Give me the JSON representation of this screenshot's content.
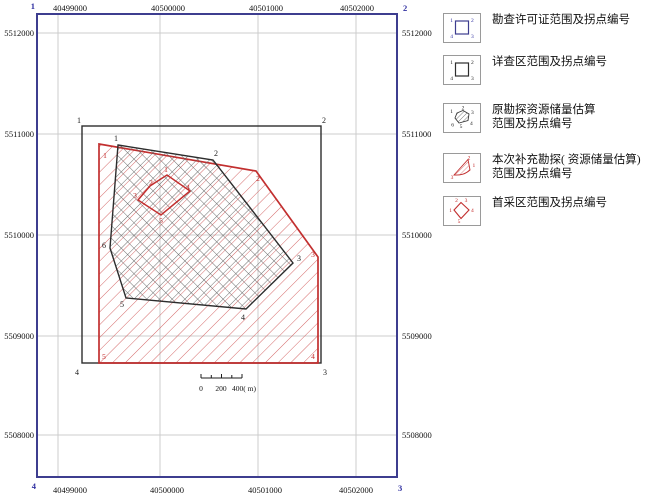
{
  "axes": {
    "x_labels": [
      "40499000",
      "40500000",
      "40501000",
      "40502000"
    ],
    "y_labels": [
      "5512000",
      "5511000",
      "5510000",
      "5509000",
      "5508000"
    ]
  },
  "permit_frame": {
    "corners": [
      "1",
      "2",
      "3",
      "4"
    ]
  },
  "survey_rect": {
    "corners": [
      "1",
      "2",
      "3",
      "4"
    ]
  },
  "exploration_polygon": {
    "corners": [
      "1",
      "2",
      "3",
      "4",
      "5",
      "6"
    ]
  },
  "supplement_polygon": {
    "corners": [
      "1",
      "2",
      "3",
      "4",
      "5"
    ]
  },
  "first_mining_area": {
    "corners": [
      "1",
      "2",
      "3",
      "4",
      "5"
    ]
  },
  "scale_bar": {
    "labels": [
      "0",
      "200",
      "400( m)"
    ]
  },
  "legend": {
    "items": [
      {
        "lines": [
          "勘查许可证范围及拐点编号"
        ]
      },
      {
        "lines": [
          "详查区范围及拐点编号"
        ]
      },
      {
        "lines": [
          "原勘探资源储量估算",
          "范围及拐点编号"
        ]
      },
      {
        "lines": [
          "本次补充勘探( 资源储量估算)",
          "范围及拐点编号"
        ]
      },
      {
        "lines": [
          "首采区范围及拐点编号"
        ]
      }
    ]
  },
  "colors": {
    "permit_blue": "#3d3d8f",
    "boundary_black": "#2d2d2d",
    "boundary_red": "#c22f2f",
    "grid_gray": "#cccccc"
  }
}
